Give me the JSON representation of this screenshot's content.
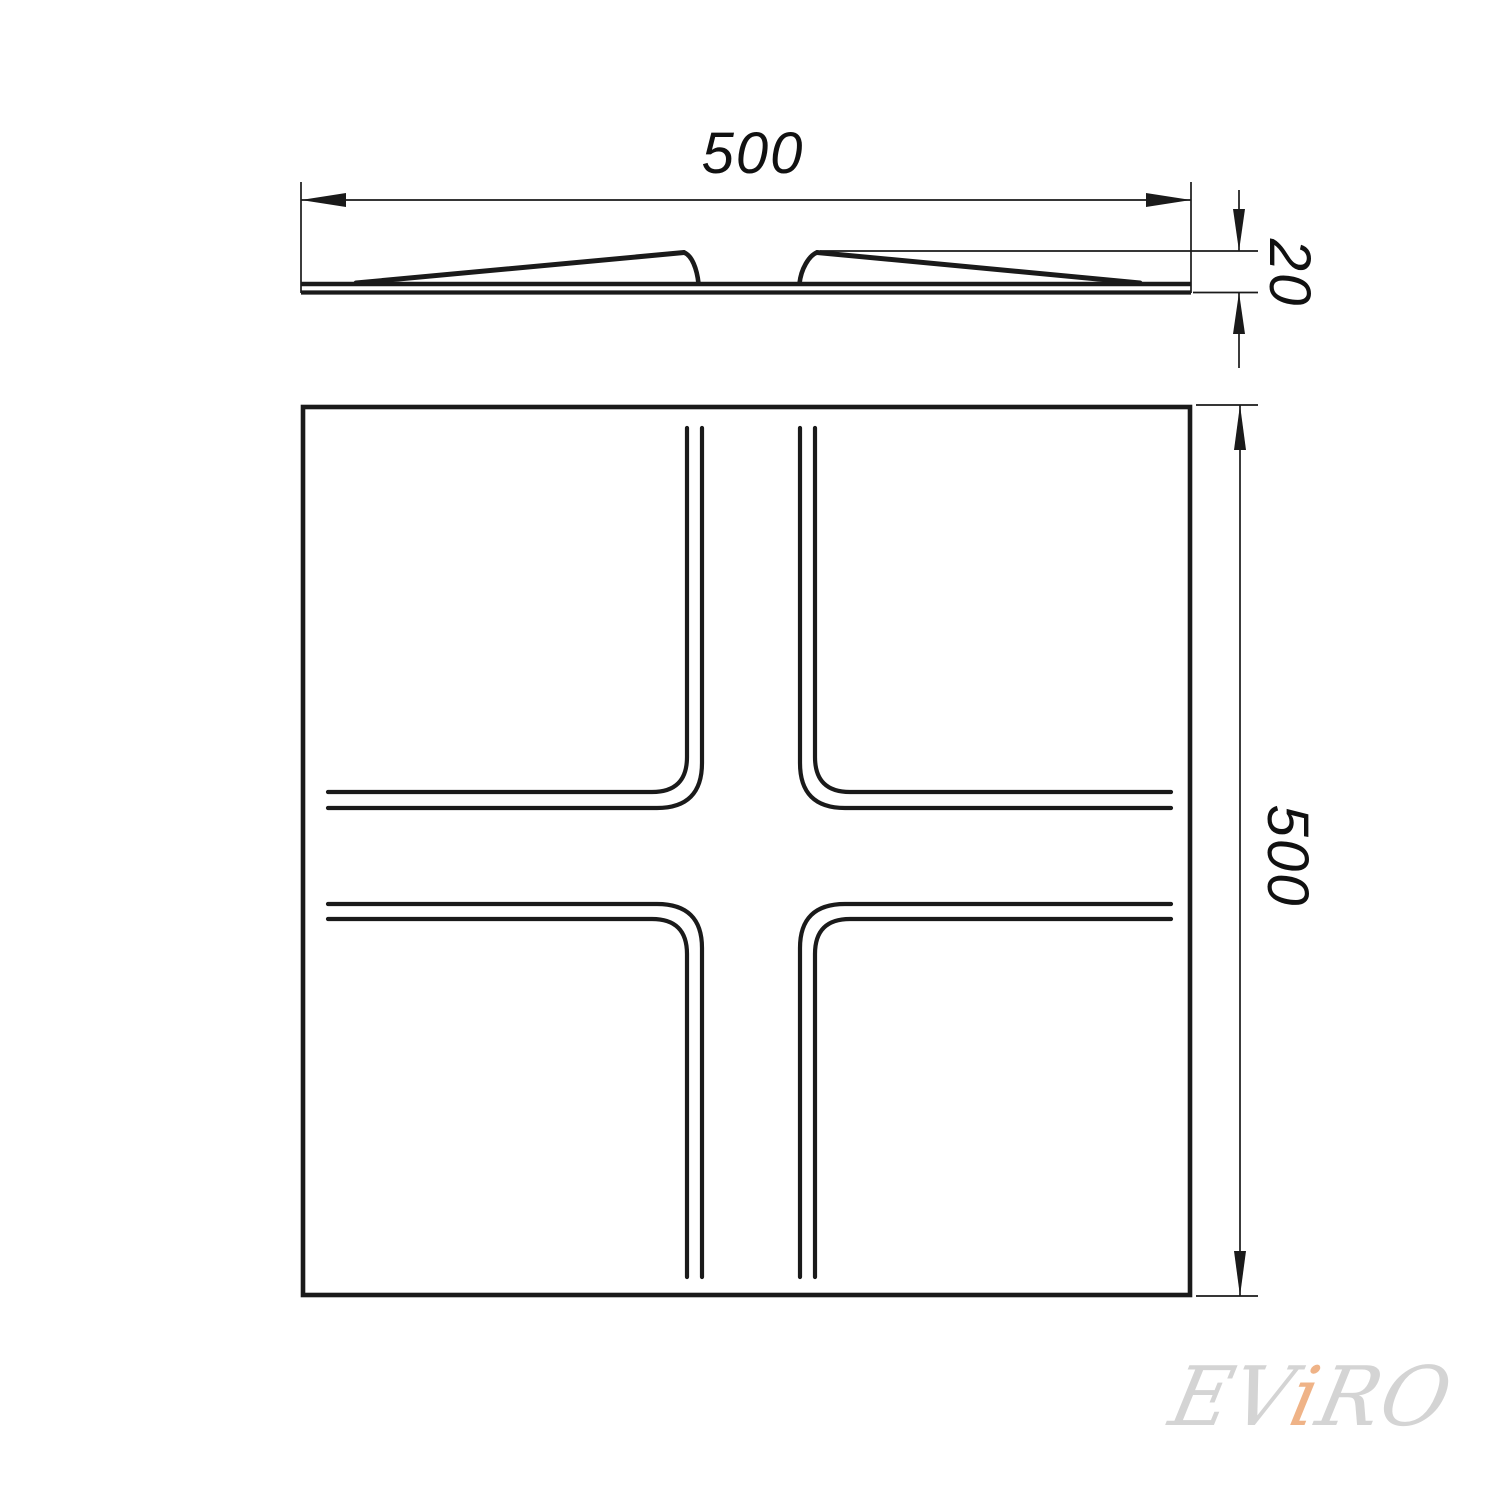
{
  "page": {
    "background": "#ffffff",
    "line_color": "#1a1a1a"
  },
  "drawing": {
    "type": "technical-drawing-panel",
    "views": [
      {
        "id": "profile-view",
        "description": "top side-profile section of panel with two wedge ridges"
      },
      {
        "id": "front-view",
        "description": "front square face with cross groove pattern of four rounded-corner quadrants"
      }
    ],
    "dimensions": {
      "width_top": "500",
      "height_right": "500",
      "thickness": "20"
    },
    "watermark": {
      "part_ev": "EV",
      "part_i": "i",
      "part_ro": "RO",
      "color_gray": "#d4d4d4",
      "color_accent": "#efb387"
    }
  }
}
